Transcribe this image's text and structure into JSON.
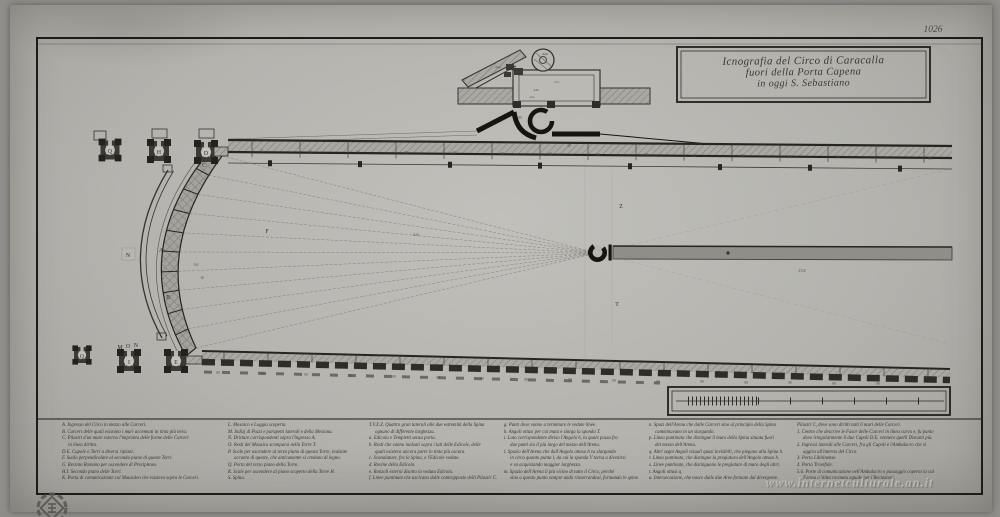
{
  "scan": {
    "plate_number": "1026",
    "watermark": "www.internetculturale.an.it",
    "colors": {
      "paper": "#b4b3ae",
      "ink": "#26251f",
      "spina_fill": "#8f8e88"
    }
  },
  "title": {
    "line1": "Icnografia del Circo di Caracalla",
    "line2": "fuori della Porta Capena",
    "line3": "in oggi S. Sebastiano"
  },
  "plan": {
    "annotations": [
      {
        "t": "Q",
        "x": 110,
        "y": 153,
        "c": "L"
      },
      {
        "t": "H",
        "x": 159,
        "y": 154,
        "c": "L"
      },
      {
        "t": "D",
        "x": 206,
        "y": 155,
        "c": "L"
      },
      {
        "t": "C",
        "x": 204,
        "y": 167,
        "c": "L"
      },
      {
        "t": "B",
        "x": 168,
        "y": 299,
        "c": "L"
      },
      {
        "t": "A",
        "x": 161,
        "y": 252,
        "c": "L"
      },
      {
        "t": "N",
        "x": 128,
        "y": 257,
        "c": "L"
      },
      {
        "t": "I",
        "x": 129,
        "y": 364,
        "c": "L"
      },
      {
        "t": "Q",
        "x": 82,
        "y": 358,
        "c": "L"
      },
      {
        "t": "E",
        "x": 176,
        "y": 364,
        "c": "L"
      },
      {
        "t": "M",
        "x": 120,
        "y": 349,
        "c": "L"
      },
      {
        "t": "O",
        "x": 128,
        "y": 348,
        "c": "L"
      },
      {
        "t": "N",
        "x": 136,
        "y": 347,
        "c": "L"
      },
      {
        "t": "F",
        "x": 267,
        "y": 233,
        "c": "L"
      },
      {
        "t": "Z",
        "x": 621,
        "y": 208,
        "c": "L"
      },
      {
        "t": "T",
        "x": 617,
        "y": 306,
        "c": "L"
      },
      {
        "t": "616",
        "x": 416,
        "y": 236,
        "c": "m"
      },
      {
        "t": "2334",
        "x": 802,
        "y": 272,
        "c": "m"
      },
      {
        "t": "9.6",
        "x": 196,
        "y": 266,
        "c": "m"
      },
      {
        "t": "16",
        "x": 202,
        "y": 279,
        "c": "m"
      },
      {
        "t": "99",
        "x": 520,
        "y": 119,
        "c": "m"
      },
      {
        "t": "99",
        "x": 569,
        "y": 147,
        "c": "m"
      },
      {
        "t": "11",
        "x": 262,
        "y": 152,
        "c": "m"
      },
      {
        "t": "99",
        "x": 310,
        "y": 153,
        "c": "m"
      },
      {
        "t": "66",
        "x": 358,
        "y": 153,
        "c": "m"
      },
      {
        "t": "99",
        "x": 406,
        "y": 154,
        "c": "m"
      },
      {
        "t": "44",
        "x": 454,
        "y": 154,
        "c": "m"
      },
      {
        "t": "99",
        "x": 502,
        "y": 155,
        "c": "m"
      },
      {
        "t": "66",
        "x": 550,
        "y": 155,
        "c": "m"
      },
      {
        "t": "99",
        "x": 598,
        "y": 156,
        "c": "m"
      },
      {
        "t": "99",
        "x": 646,
        "y": 156,
        "c": "m"
      },
      {
        "t": "66",
        "x": 694,
        "y": 157,
        "c": "m"
      },
      {
        "t": "99",
        "x": 742,
        "y": 157,
        "c": "m"
      },
      {
        "t": "99",
        "x": 790,
        "y": 158,
        "c": "m"
      },
      {
        "t": "66",
        "x": 838,
        "y": 158,
        "c": "m"
      },
      {
        "t": "99",
        "x": 886,
        "y": 159,
        "c": "m"
      },
      {
        "t": "99",
        "x": 930,
        "y": 160,
        "c": "m"
      },
      {
        "t": "99",
        "x": 218,
        "y": 374,
        "c": "m"
      },
      {
        "t": "99",
        "x": 262,
        "y": 375,
        "c": "m"
      },
      {
        "t": "99",
        "x": 306,
        "y": 376,
        "c": "m"
      },
      {
        "t": "99",
        "x": 350,
        "y": 377,
        "c": "m"
      },
      {
        "t": "99",
        "x": 394,
        "y": 378,
        "c": "m"
      },
      {
        "t": "99",
        "x": 438,
        "y": 379,
        "c": "m"
      },
      {
        "t": "99",
        "x": 482,
        "y": 380,
        "c": "m"
      },
      {
        "t": "99",
        "x": 526,
        "y": 381,
        "c": "m"
      },
      {
        "t": "99",
        "x": 570,
        "y": 381,
        "c": "m"
      },
      {
        "t": "99",
        "x": 614,
        "y": 382,
        "c": "m"
      },
      {
        "t": "99",
        "x": 658,
        "y": 383,
        "c": "m"
      },
      {
        "t": "99",
        "x": 702,
        "y": 383,
        "c": "m"
      },
      {
        "t": "99",
        "x": 746,
        "y": 384,
        "c": "m"
      },
      {
        "t": "99",
        "x": 790,
        "y": 384,
        "c": "m"
      },
      {
        "t": "99",
        "x": 834,
        "y": 385,
        "c": "m"
      },
      {
        "t": "99",
        "x": 878,
        "y": 385,
        "c": "m"
      },
      {
        "t": "aaa",
        "x": 498,
        "y": 68,
        "c": "i"
      },
      {
        "t": "ddd",
        "x": 545,
        "y": 55,
        "c": "i"
      },
      {
        "t": "ccc",
        "x": 557,
        "y": 83,
        "c": "i"
      },
      {
        "t": "eee",
        "x": 532,
        "y": 98,
        "c": "i"
      },
      {
        "t": "444",
        "x": 536,
        "y": 91,
        "c": "i"
      }
    ]
  },
  "legend": {
    "columns": [
      {
        "lines": [
          "A. Ingresso del Circo in mezzo alle Carceri.",
          "B. Carceri delle quali esistono i muri accennati in tinta più nera.",
          "C. Pilastri d'un muro esterno l'impronta delle forme delle Carceri",
          "     in linea diritta.",
          "D.E. Cupole o Torri a diversi ripiani.",
          "F. Suolo perpendicolare al secondo piano di queste Torri.",
          "G. Recinto Romano per ascendere di Precipitoso.",
          "H.I. Secondo piano delle Torri.",
          "K. Porta di comunicazione col Mausoleo che esisteva sopra le Carceri."
        ]
      },
      {
        "lines": [
          "L. Mosaico e Loggia scoperta.",
          "M. Indizj di Pozzi e parapetti laterali e della Mesiana.",
          "N. Dritture corrispondenti sopra l'ingresso A.",
          "O. Resti del Mosaico scomparsi nella Torre T.",
          "P. Scale per ascendere al terzo piano di questa Torre, inalzate",
          "     accanto di queste, che anticamente si credono di legno.",
          "Q. Porta del terzo piano della Torre.",
          "R. Scale per ascendere al piano scoperto della Torre H.",
          "S. Spina."
        ]
      },
      {
        "lines": [
          "T.V.X.Z. Quattro gran laterali alle due estremità della Spina",
          "     ognuno di differente larghezza.",
          "a. Edicola e Tempietti senza porta.",
          "b. Resti che vanno inalzati sopra i lati delle Edicole, delle",
          "     quali esisteva ancora parte in tinta più oscura.",
          "c. Scanalature, fra la Spina, e l'Edicole vedute.",
          "d. Rovine della Edicola.",
          "e. Ronzoli esterni disotto la veduta Edicola.",
          "f. Linee puntinate che uscivano dalle contrapposte delli Pilastri C."
        ]
      },
      {
        "lines": [
          "g. Punti dove vanno a terminare le vedute linee.",
          "h. Angoli ottusi per cui muta e slarga la sponda T.",
          "i. Lato corrispondente diviso l'Angolo h, la quale passa fra",
          "     due punti sia il più largo del mezzo dell'Arena.",
          "l. Spazio dell'Arena che dall'Angolo ottuso h va slargando",
          "     in circa quanto punta l, da cui la sponda V torna a divenirsi",
          "     e va acquistando maggior larghezza.",
          "m. Spazio dell'Arena il più vicino di tutto il Circo, perché",
          "     sino a questo punto sempre andò rinserrandosi, formando le spine."
        ]
      },
      {
        "lines": [
          "n. Spazi dell'Arena che dalle Carceri sino al principio della Spina",
          "     camminavano in un slargando.",
          "p. Linea puntinata che distingue il muro della Spina situata fuori",
          "     del mezzo dell'Arena.",
          "q. Altri segni Angoli visuali quasi invisibili, che piegano alla Spina h.",
          "r. Linea puntinata, che distingue la pregiatura dell'Angolo ottuso h.",
          "s. Linee puntinate, che distinguono le pregiature di muro degli altri.",
          "t. Angoli ottusi q.",
          "u. Intersecazione, che nasce dalle due Aree formate dal divergente."
        ]
      },
      {
        "lines": [
          "Pilastri C, dove sono diritti tutti li muri delle Carceri.",
          "1. Centro che descrive le Fasce delle Carceri in linea curva e, fu punto",
          "     dove irregolarmente li due Cupoli D.E. vennero quelli Distanti più.",
          "2. Ingressi laterali alle Carceri, fra gli Cupoli e l'Ambulacro che si",
          "     aggira all'interno del Circo.",
          "3. Porta Libitinense.",
          "4. Porta Trionfale.",
          "5.6. Porte di comunicazione nell'Ambulacro o passaggio coperto la cui",
          "     Forma o Volta rovinata eguale per l'Recinzioni."
        ]
      }
    ]
  }
}
